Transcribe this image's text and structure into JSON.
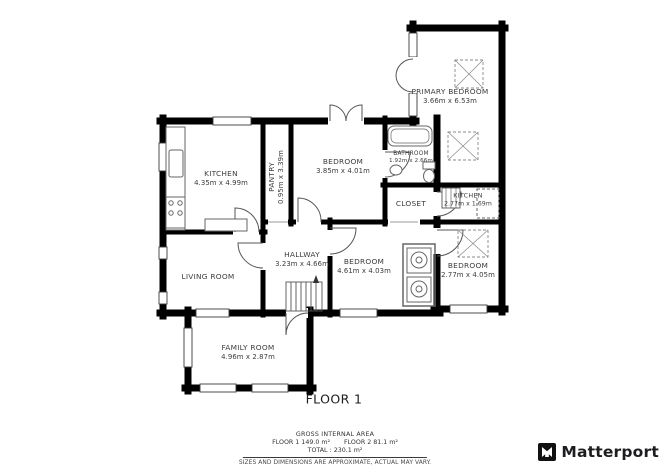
{
  "plan": {
    "floor_label": "FLOOR 1",
    "rooms": {
      "primary_bedroom": {
        "name": "PRIMARY BEDROOM",
        "dims": "3.66m x 6.53m"
      },
      "kitchen": {
        "name": "KITCHEN",
        "dims": "4.35m x 4.99m"
      },
      "pantry": {
        "name": "PANTRY",
        "dims": "0.95m x 3.39m"
      },
      "bedroom_middle": {
        "name": "BEDROOM",
        "dims": "3.85m x 4.01m"
      },
      "bathroom": {
        "name": "BATHROOM",
        "dims": "1.92m x 2.66m"
      },
      "closet": {
        "name": "CLOSET",
        "dims": ""
      },
      "kitchen_small": {
        "name": "KITCHEN",
        "dims": "2.77m x 1.69m"
      },
      "hallway": {
        "name": "HALLWAY",
        "dims": "3.23m x 4.66m"
      },
      "living_room": {
        "name": "LIVING ROOM",
        "dims": ""
      },
      "bedroom_lower": {
        "name": "BEDROOM",
        "dims": "4.61m x 4.03m"
      },
      "bedroom_right": {
        "name": "BEDROOM",
        "dims": "2.77m x 4.05m"
      },
      "family_room": {
        "name": "FAMILY ROOM",
        "dims": "4.96m x 2.87m"
      }
    }
  },
  "footer": {
    "gross_title": "GROSS INTERNAL AREA",
    "floor1_area": "FLOOR 1 149.0 m²",
    "floor2_area": "FLOOR 2 81.1 m²",
    "total_line": "TOTAL :  230.1 m²",
    "disclaimer": "SIZES AND DIMENSIONS ARE APPROXIMATE, ACTUAL MAY VARY.",
    "brand": "Matterport"
  },
  "colors": {
    "wall": "#000000",
    "label_text": "#3c3c3c",
    "accent": "#1d1d1f"
  }
}
